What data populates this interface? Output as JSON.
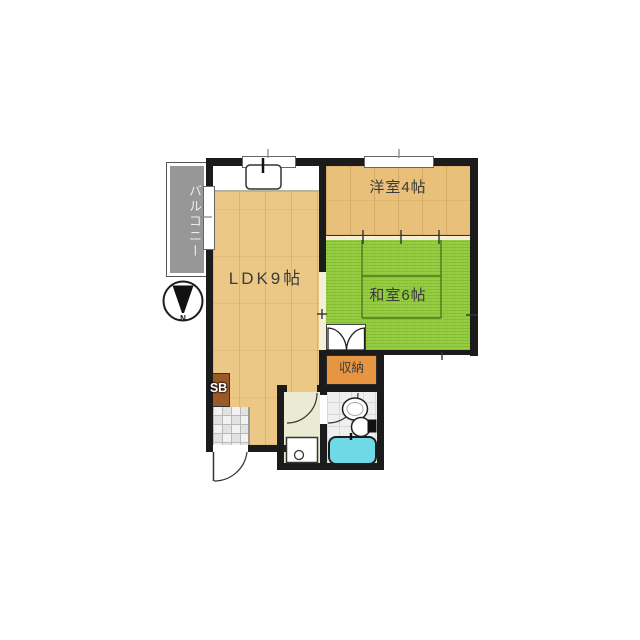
{
  "floorplan": {
    "background_color": "#ffffff",
    "wall_color": "#1b1b1b",
    "rooms": {
      "balcony": {
        "label": "バルコニー",
        "color": "#979797"
      },
      "ldk": {
        "label": "LDK9帖",
        "color": "#ecc886"
      },
      "western": {
        "label": "洋室4帖",
        "color": "#e8c079"
      },
      "japanese": {
        "label": "和室6帖",
        "color": "#90cc36"
      },
      "storage": {
        "label": "収納",
        "color": "#e79540"
      },
      "shoebox": {
        "label": "SB",
        "color": "#9a5a28"
      }
    },
    "fixtures": {
      "bathtub_color": "#70d9e6",
      "items": [
        "kitchen-sink",
        "toilet",
        "washbasin",
        "bathtub",
        "washing-machine-pan"
      ]
    },
    "compass": {
      "label": "N",
      "direction": "down"
    }
  }
}
